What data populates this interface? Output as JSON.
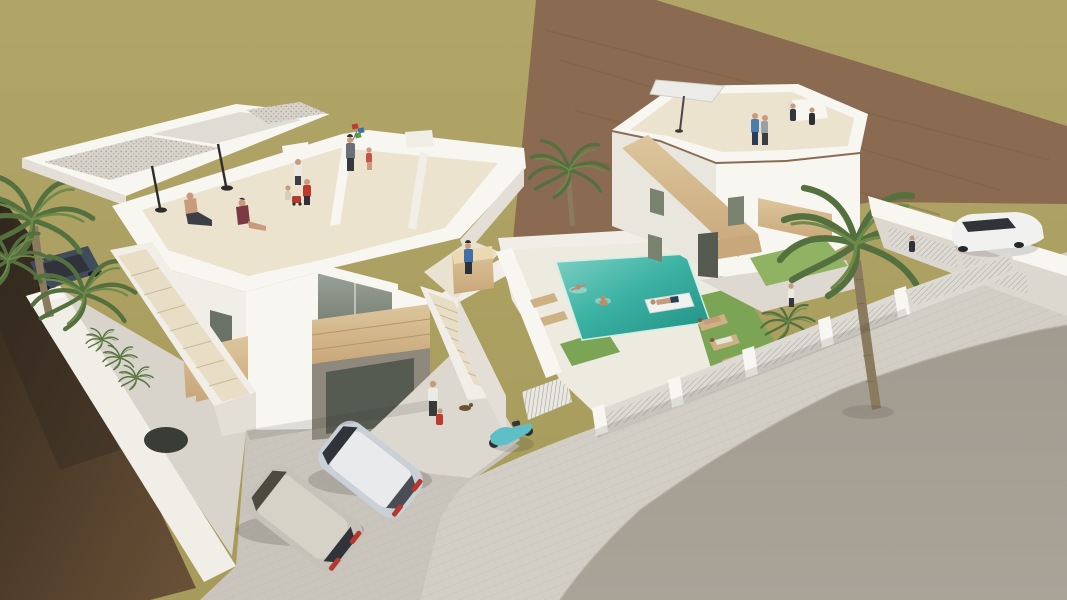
{
  "scene": {
    "description": "Aerial 3D architectural rendering of two modern white villas with rooftop terraces and people, external staircases with wooden accents, a turquoise swimming pool with swimmers and a float, sun loungers on lawns, palm trees, parked cars, a teal scooter, white perimeter walls with lattice fences, a cobbled sidewalk and a wide gray street in front, olive-green empty field and brown dirt strip behind",
    "objects": {
      "left_villa": "white villa with rooftop terrace, closed parasols, seated couple and playing children",
      "right_villa": "white villa with hexagonal rooftop terrace, white parasol and standing people",
      "pool": "turquoise pool with two swimmers and person on white float",
      "vehicles": [
        "silver hatchback",
        "beige van",
        "dark blue car",
        "white car",
        "teal scooter"
      ],
      "vegetation": [
        "large palm tree",
        "small pool palm",
        "left palm cluster",
        "shrubs"
      ],
      "ground": [
        "olive field",
        "brown dirt strip",
        "dark soil",
        "cobbled sidewalk",
        "asphalt road",
        "green lawns"
      ]
    }
  },
  "palette": {
    "field": "#a79b5b",
    "fieldLight": "#b0a467",
    "dirtStrip": "#8a6a50",
    "dirtLine": "#7a5c44",
    "soilDark": "#33281c",
    "soilLight": "#6b5238",
    "road": "#a29b90",
    "roadLight": "#aaa398",
    "sidewalk": "#d2cec5",
    "paverLine": "#b4afa5",
    "cobble": "#c9c5bc",
    "whiteBright": "#f8f6f1",
    "whiteLit": "#f1eee7",
    "whiteShade": "#e3dfd7",
    "whiteDeep": "#c9c4ba",
    "recess": "#8f897d",
    "terrace": "#ece3cf",
    "tread": "#e8dec6",
    "treadLine": "#c9bb9c",
    "wood": "#ddc69c",
    "woodLight": "#ecd9b4",
    "woodDark": "#c8a77a",
    "glass": "#79816f",
    "glassDark": "#565b52",
    "gravel": "#d7d3ca",
    "gravelDot": "#a9a49a",
    "pool": "#3db3a4",
    "poolLight": "#7fd0c4",
    "poolDeep": "#1f8f83",
    "lawn": "#7ca455",
    "lawnLight": "#8fb363",
    "palm": "#55703f",
    "palmLight": "#6d8a4a",
    "trunk": "#8a7a5e",
    "skin": "#c99b7d",
    "red": "#bf3a2c",
    "blue": "#4d7cb0",
    "navy": "#2e3d55",
    "darkCloth": "#33363c",
    "grayCloth": "#9aa0a6",
    "whiteCloth": "#eceae4",
    "wine": "#7a3b43",
    "scooter": "#5fbfc6",
    "carSilver": "#c9d0d6",
    "carSilverTop": "#e8eaec",
    "carVan": "#c6c2ba",
    "carBlue": "#3f4c5c",
    "carWhite": "#f1f2f0",
    "carWindow": "#30343a",
    "tailRed": "#b5372e",
    "umbrella": "#2f2d2b",
    "parasol": "#ebebe7",
    "fencePanel": "#dcdad3",
    "fenceLine": "#9b968c",
    "courtyard": "#d8d4cb",
    "shadow": "#2a2620"
  }
}
